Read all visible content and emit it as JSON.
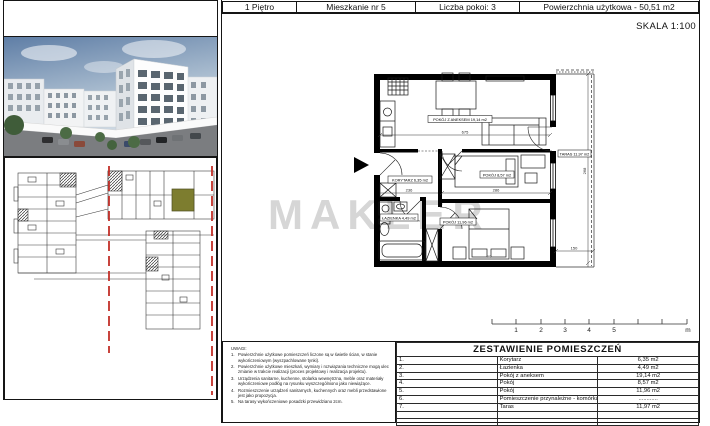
{
  "header": {
    "floor": "1 Piętro",
    "apartment": "Mieszkanie nr 5",
    "rooms_count": "Liczba pokoi: 3",
    "usable_area": "Powierzchnia użytkowa - 50,51 m2",
    "scale": "SKALA 1:100"
  },
  "watermark": "MAKLER",
  "plan": {
    "room_labels": {
      "living": "POKÓJ Z ANEKSEM  19,14 m2",
      "corridor": "KORYTARZ  6,35 m2",
      "bedroom_small": "POKÓJ  8,57 m2",
      "bedroom_large": "POKÓJ  11,96 m2",
      "bathroom": "ŁAZIENKA  4,49 m2",
      "terrace": "TARAS  11,97 m2"
    },
    "dimensions": [
      "675",
      "286",
      "236",
      "150",
      "268",
      "90"
    ]
  },
  "scalebar": {
    "ticks": [
      "1",
      "2",
      "3",
      "4",
      "5"
    ],
    "unit": "m"
  },
  "notes": {
    "title": "UWAGI:",
    "items": [
      {
        "no": "1.",
        "text": "Powierzchnie użytkowe pomieszczeń liczone są w świetle ścian, w stanie wykończeniowym (wyszpachlowane tynki)."
      },
      {
        "no": "2.",
        "text": "Powierzchnie użytkowe mieszkań, wymiary i rozwiązania techniczne mogą ulec zmianie w trakcie realizacji (proces projektowy i realizacja projektu)."
      },
      {
        "no": "3.",
        "text": "Urządzenia sanitarne, kuchenne, stolarka wewnętrzna, meble oraz materiały wykończeniowe podłóg na rysunku wyszczególniono jako niewiążące."
      },
      {
        "no": "4.",
        "text": "Rozmieszczenie urządzeń sanitarnych, kuchennych oraz mebli przedstawione jest jako propozycja."
      },
      {
        "no": "5.",
        "text": "Na tarasy wykończeniowe posadzki przewidziano 2cm."
      }
    ]
  },
  "rooms_table": {
    "title": "ZESTAWIENIE POMIESZCZEŃ",
    "rows": [
      {
        "no": "1.",
        "name": "Korytarz",
        "area": "6,35 m2"
      },
      {
        "no": "2.",
        "name": "Łazienka",
        "area": "4,49 m2"
      },
      {
        "no": "3.",
        "name": "Pokój z aneksem",
        "area": "19,14 m2"
      },
      {
        "no": "4.",
        "name": "Pokój",
        "area": "8,57 m2"
      },
      {
        "no": "5.",
        "name": "Pokój",
        "area": "11,96 m2"
      },
      {
        "no": "6.",
        "name": "Pomieszczenie przynależne - komórka lokatorska nr ............",
        "area": "............"
      },
      {
        "no": "7.",
        "name": "Taras",
        "area": "11,97 m2"
      }
    ]
  },
  "colors": {
    "section_cut_red": "#c23028",
    "highlighted_unit": "#7d7d2f",
    "watermark_gray": "#d6d6d6"
  }
}
